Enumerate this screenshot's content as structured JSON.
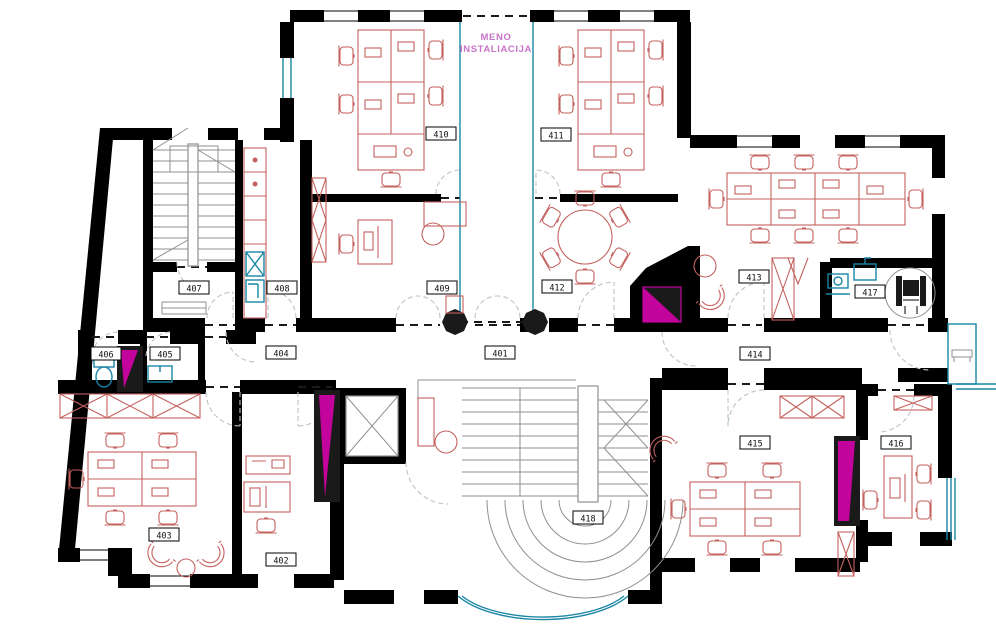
{
  "drawing": {
    "title": {
      "line1": "MENO",
      "line2": "INSTALIACIJA"
    }
  },
  "rooms": [
    {
      "number": "401",
      "x": 500,
      "y": 353
    },
    {
      "number": "402",
      "x": 281,
      "y": 560
    },
    {
      "number": "403",
      "x": 164,
      "y": 535
    },
    {
      "number": "404",
      "x": 281,
      "y": 353
    },
    {
      "number": "405",
      "x": 165,
      "y": 354
    },
    {
      "number": "406",
      "x": 106,
      "y": 354
    },
    {
      "number": "407",
      "x": 194,
      "y": 288
    },
    {
      "number": "408",
      "x": 282,
      "y": 288
    },
    {
      "number": "409",
      "x": 442,
      "y": 288
    },
    {
      "number": "410",
      "x": 441,
      "y": 134
    },
    {
      "number": "411",
      "x": 556,
      "y": 135
    },
    {
      "number": "412",
      "x": 557,
      "y": 287
    },
    {
      "number": "413",
      "x": 754,
      "y": 277
    },
    {
      "number": "414",
      "x": 755,
      "y": 354
    },
    {
      "number": "415",
      "x": 755,
      "y": 443
    },
    {
      "number": "416",
      "x": 896,
      "y": 443
    },
    {
      "number": "417",
      "x": 870,
      "y": 292
    },
    {
      "number": "418",
      "x": 588,
      "y": 518
    }
  ],
  "colors": {
    "wall": "#000000",
    "furniture": "#c4615e",
    "fixture": "#1a85a4",
    "shaft": "#c2049c",
    "stair": "#8f8f8f",
    "door": "#b9c3cb",
    "title": "#c973c9",
    "label_text": "#111111",
    "label_bg": "#ffffff"
  }
}
